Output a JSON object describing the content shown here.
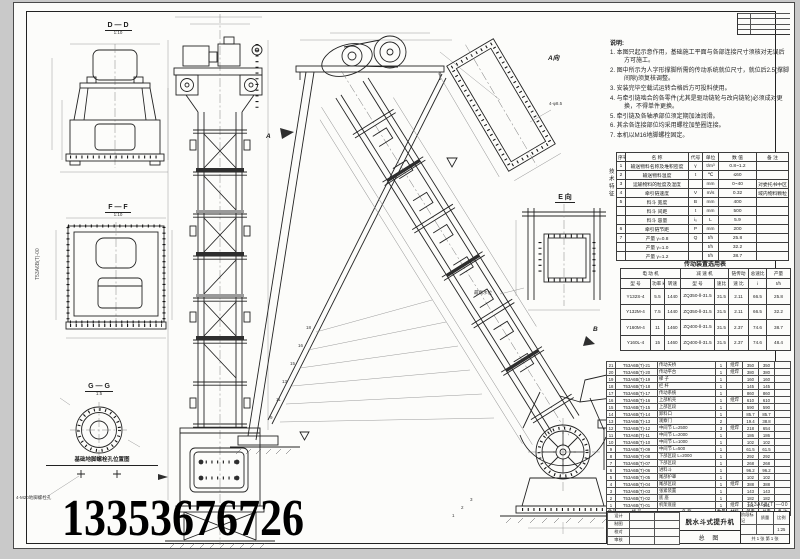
{
  "page": {
    "phone": "13353676726"
  },
  "labels": {
    "section_dd": "D — D",
    "scale_dd": "1:10",
    "section_ff": "F — F",
    "scale_ff": "1:10",
    "section_gg": "G — G",
    "scale_gg": "1:5",
    "anchor_caption": "基础地脚螺栓孔位置图",
    "anchor_note": "4-M20地脚螺栓孔",
    "view_a": "A向",
    "view_e": "E 向",
    "mark_a": "A",
    "mark_b": "B",
    "hole_note": "4-φ8.5",
    "water_line": "最高水位",
    "margin_code": "T53A6B(T)-00",
    "leaders": [
      "18",
      "16",
      "15",
      "13",
      "11",
      "9"
    ],
    "leaders_b": [
      "3",
      "2",
      "1"
    ]
  },
  "notes": {
    "title": "说明:",
    "items": [
      "1. 本图只起示意作用，基础施工平面与各部连接尺寸须核对无误后方可施工。",
      "2. 图中所示为人字形撑脚所需的传动系统就位尺寸，就位后2.5(撑脚间隙)须复核调整。",
      "3. 安装完毕空载试运转合格后方可投料使用。",
      "4. 与牵引链啮合的各零件(尤其是驱动链轮与改向链轮)必须成对更换，不得单件更换。",
      "5. 牵引链及各轴承部位须定期加油润滑。",
      "6. 其余各连接部位均采用螺栓加垫圈连接。",
      "7. 本机以M16地脚螺栓固定。"
    ]
  },
  "spec_table": {
    "side_label": "技术特征",
    "headers": [
      "序号",
      "名    称",
      "代号",
      "单位",
      "数  值",
      "备  注"
    ],
    "rows": [
      [
        "1",
        "输送物料名称及堆积密度",
        "γ",
        "t/m³",
        "0.8~1.2",
        ""
      ],
      [
        "2",
        "输送物料温度",
        "t",
        "℃",
        "≤60",
        ""
      ],
      [
        "3",
        "运输物料的粒度及湿度",
        "",
        "mm",
        "0~40",
        "对委托书中区"
      ],
      [
        "4",
        "牵引链速度",
        "V",
        "m/s",
        "0.32",
        "域内物料颗粒"
      ],
      [
        "5",
        "料斗  宽度",
        "B",
        "mm",
        "400",
        ""
      ],
      [
        "",
        "料斗  间距",
        "t",
        "mm",
        "500",
        ""
      ],
      [
        "",
        "料斗  容量",
        "i₀",
        "L",
        "5.9",
        ""
      ],
      [
        "6",
        "牵引链节距",
        "P",
        "mm",
        "200",
        ""
      ],
      [
        "7",
        "产量  γ=0.8",
        "Q",
        "t/h",
        "25.8",
        ""
      ],
      [
        "",
        "产量  γ=1.0",
        "",
        "t/h",
        "32.2",
        ""
      ],
      [
        "",
        "产量  γ=1.2",
        "",
        "t/h",
        "38.7",
        ""
      ]
    ]
  },
  "drive_table": {
    "title": "传动装置选用表",
    "g1": "电  动  机",
    "g2": "减  速  机",
    "g3": "链传动",
    "g4": "总速比",
    "g5": "产量",
    "sub": [
      "型  号",
      "功率 kW",
      "转速",
      "型    号",
      "速比",
      "速 比",
      "i",
      "t/h"
    ],
    "rows": [
      [
        "Y132S-4",
        "5.5",
        "1440",
        "ZQ350-Ⅱ-31.5",
        "31.5",
        "2.11",
        "66.5",
        "25.8"
      ],
      [
        "Y132M-4",
        "7.5",
        "1440",
        "ZQ350-Ⅱ-31.5",
        "31.5",
        "2.11",
        "66.5",
        "32.2"
      ],
      [
        "Y160M-4",
        "11",
        "1460",
        "ZQ400-Ⅱ-31.5",
        "31.5",
        "2.37",
        "74.6",
        "38.7"
      ],
      [
        "Y160L-4",
        "15",
        "1460",
        "ZQ400-Ⅱ-31.5",
        "31.5",
        "2.37",
        "74.6",
        "48.4"
      ]
    ]
  },
  "bom_table": {
    "headers": [
      "件号",
      "代    号",
      "名    称",
      "数量",
      "材料",
      "单重",
      "总重",
      "备 注"
    ],
    "rows": [
      [
        "21",
        "T53A6B(T)-21",
        "传动天桥",
        "1",
        "组焊",
        "350",
        "350",
        ""
      ],
      [
        "20",
        "T53A6B(T)-20",
        "传动平台",
        "1",
        "组焊",
        "380",
        "380",
        ""
      ],
      [
        "19",
        "T53A6B(T)-19",
        "梯  子",
        "1",
        "",
        "160",
        "160",
        ""
      ],
      [
        "18",
        "T53A6B(T)-18",
        "栏  杆",
        "1",
        "",
        "145",
        "145",
        ""
      ],
      [
        "17",
        "T53A6B(T)-17",
        "传动系统",
        "1",
        "",
        "860",
        "860",
        ""
      ],
      [
        "16",
        "T53A6B(T)-16",
        "上部机壳",
        "1",
        "组焊",
        "610",
        "610",
        ""
      ],
      [
        "15",
        "T53A6B(T)-15",
        "上部区段",
        "1",
        "",
        "590",
        "590",
        ""
      ],
      [
        "14",
        "T53A6B(T)-14",
        "卸料口",
        "1",
        "",
        "85.7",
        "85.7",
        ""
      ],
      [
        "13",
        "T53A6B(T)-13",
        "观察门",
        "2",
        "",
        "19.4",
        "38.8",
        ""
      ],
      [
        "12",
        "T53A6B(T)-12",
        "中间节 L=2500",
        "3",
        "组焊",
        "218",
        "654",
        ""
      ],
      [
        "11",
        "T53A6B(T)-11",
        "中间节 L=2000",
        "1",
        "",
        "186",
        "186",
        ""
      ],
      [
        "10",
        "T53A6B(T)-10",
        "中间节 L=1000",
        "1",
        "",
        "102",
        "102",
        ""
      ],
      [
        "9",
        "T53A6B(T)-09",
        "中间节 L=500",
        "1",
        "",
        "61.5",
        "61.5",
        ""
      ],
      [
        "8",
        "T53A6B(T)-08",
        "下部区段 L=2000",
        "1",
        "",
        "292",
        "292",
        ""
      ],
      [
        "7",
        "T53A6B(T)-07",
        "下部区段",
        "1",
        "",
        "268",
        "268",
        ""
      ],
      [
        "6",
        "T53A6B(T)-06",
        "进料斗",
        "1",
        "",
        "96.2",
        "96.2",
        ""
      ],
      [
        "5",
        "T53A6B(T)-05",
        "尾部护罩",
        "1",
        "",
        "102",
        "102",
        ""
      ],
      [
        "4",
        "T53A6B(T)-04",
        "尾部区段",
        "1",
        "组焊",
        "388",
        "388",
        ""
      ],
      [
        "3",
        "T53A6B(T)-03",
        "张紧装置",
        "1",
        "",
        "143",
        "143",
        ""
      ],
      [
        "2",
        "T53A6B(T)-02",
        "底  座",
        "1",
        "",
        "182",
        "182",
        ""
      ],
      [
        "1",
        "T53A6B(T)-01",
        "机架底座",
        "1",
        "组焊",
        "191",
        "191",
        ""
      ]
    ]
  },
  "title_block": {
    "sign_rows": [
      [
        "设计",
        "",
        ""
      ],
      [
        "制图",
        "",
        ""
      ],
      [
        "校对",
        "",
        ""
      ],
      [
        "审核",
        "",
        ""
      ]
    ],
    "product": "脱水斗式提升机",
    "drawing_type": "总 图",
    "code": "T53A6B(T)—00",
    "scale_label": "比例",
    "scale": "1:25",
    "stage_label": "阶段标记",
    "mass_label": "质量",
    "sheets": "共 1 张 第 1 张"
  }
}
